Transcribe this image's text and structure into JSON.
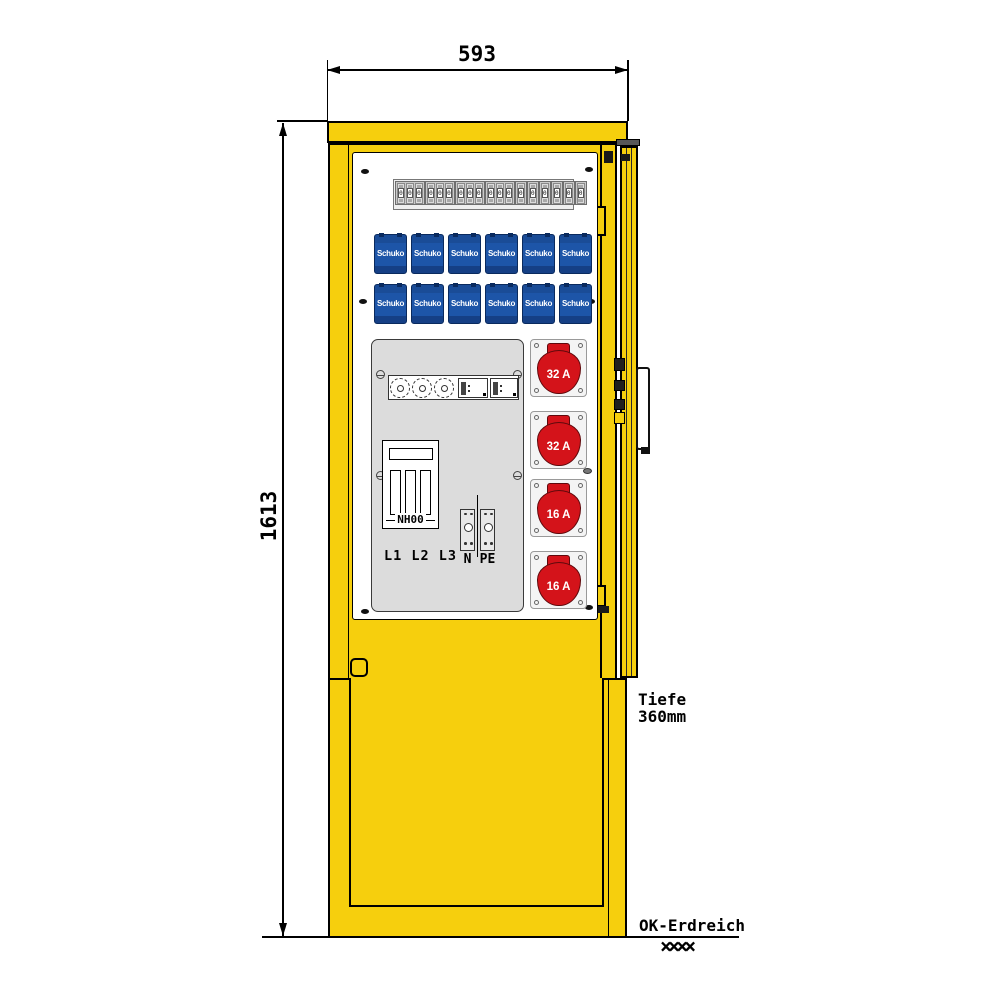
{
  "drawing": {
    "title": "power-distribution-pillar-front-view",
    "dimensions": {
      "width": "593",
      "height": "1613",
      "depth_line1": "Tiefe",
      "depth_line2": "360mm",
      "ground": "OK-Erdreich",
      "ground_hatch": "××××"
    },
    "labels": {
      "fuse_switch": "NH00",
      "phases": "L1 L2 L3",
      "neutral": "N",
      "earth": "PE"
    },
    "breakers": {
      "toggle": "0",
      "groups": [
        3,
        3,
        3,
        3,
        1,
        1,
        1,
        1,
        1,
        1
      ]
    },
    "schuko": {
      "label": "Schuko",
      "rows": 2,
      "per_row": 6
    },
    "cee_sockets": [
      "32 A",
      "32 A",
      "16 A",
      "16 A"
    ],
    "colors": {
      "cabinet_yellow": "#F6CF0D",
      "socket_blue": "#1D55A8",
      "cee_red": "#D4131A",
      "panel_gray": "#DCDCDC",
      "outline": "#000000"
    }
  }
}
